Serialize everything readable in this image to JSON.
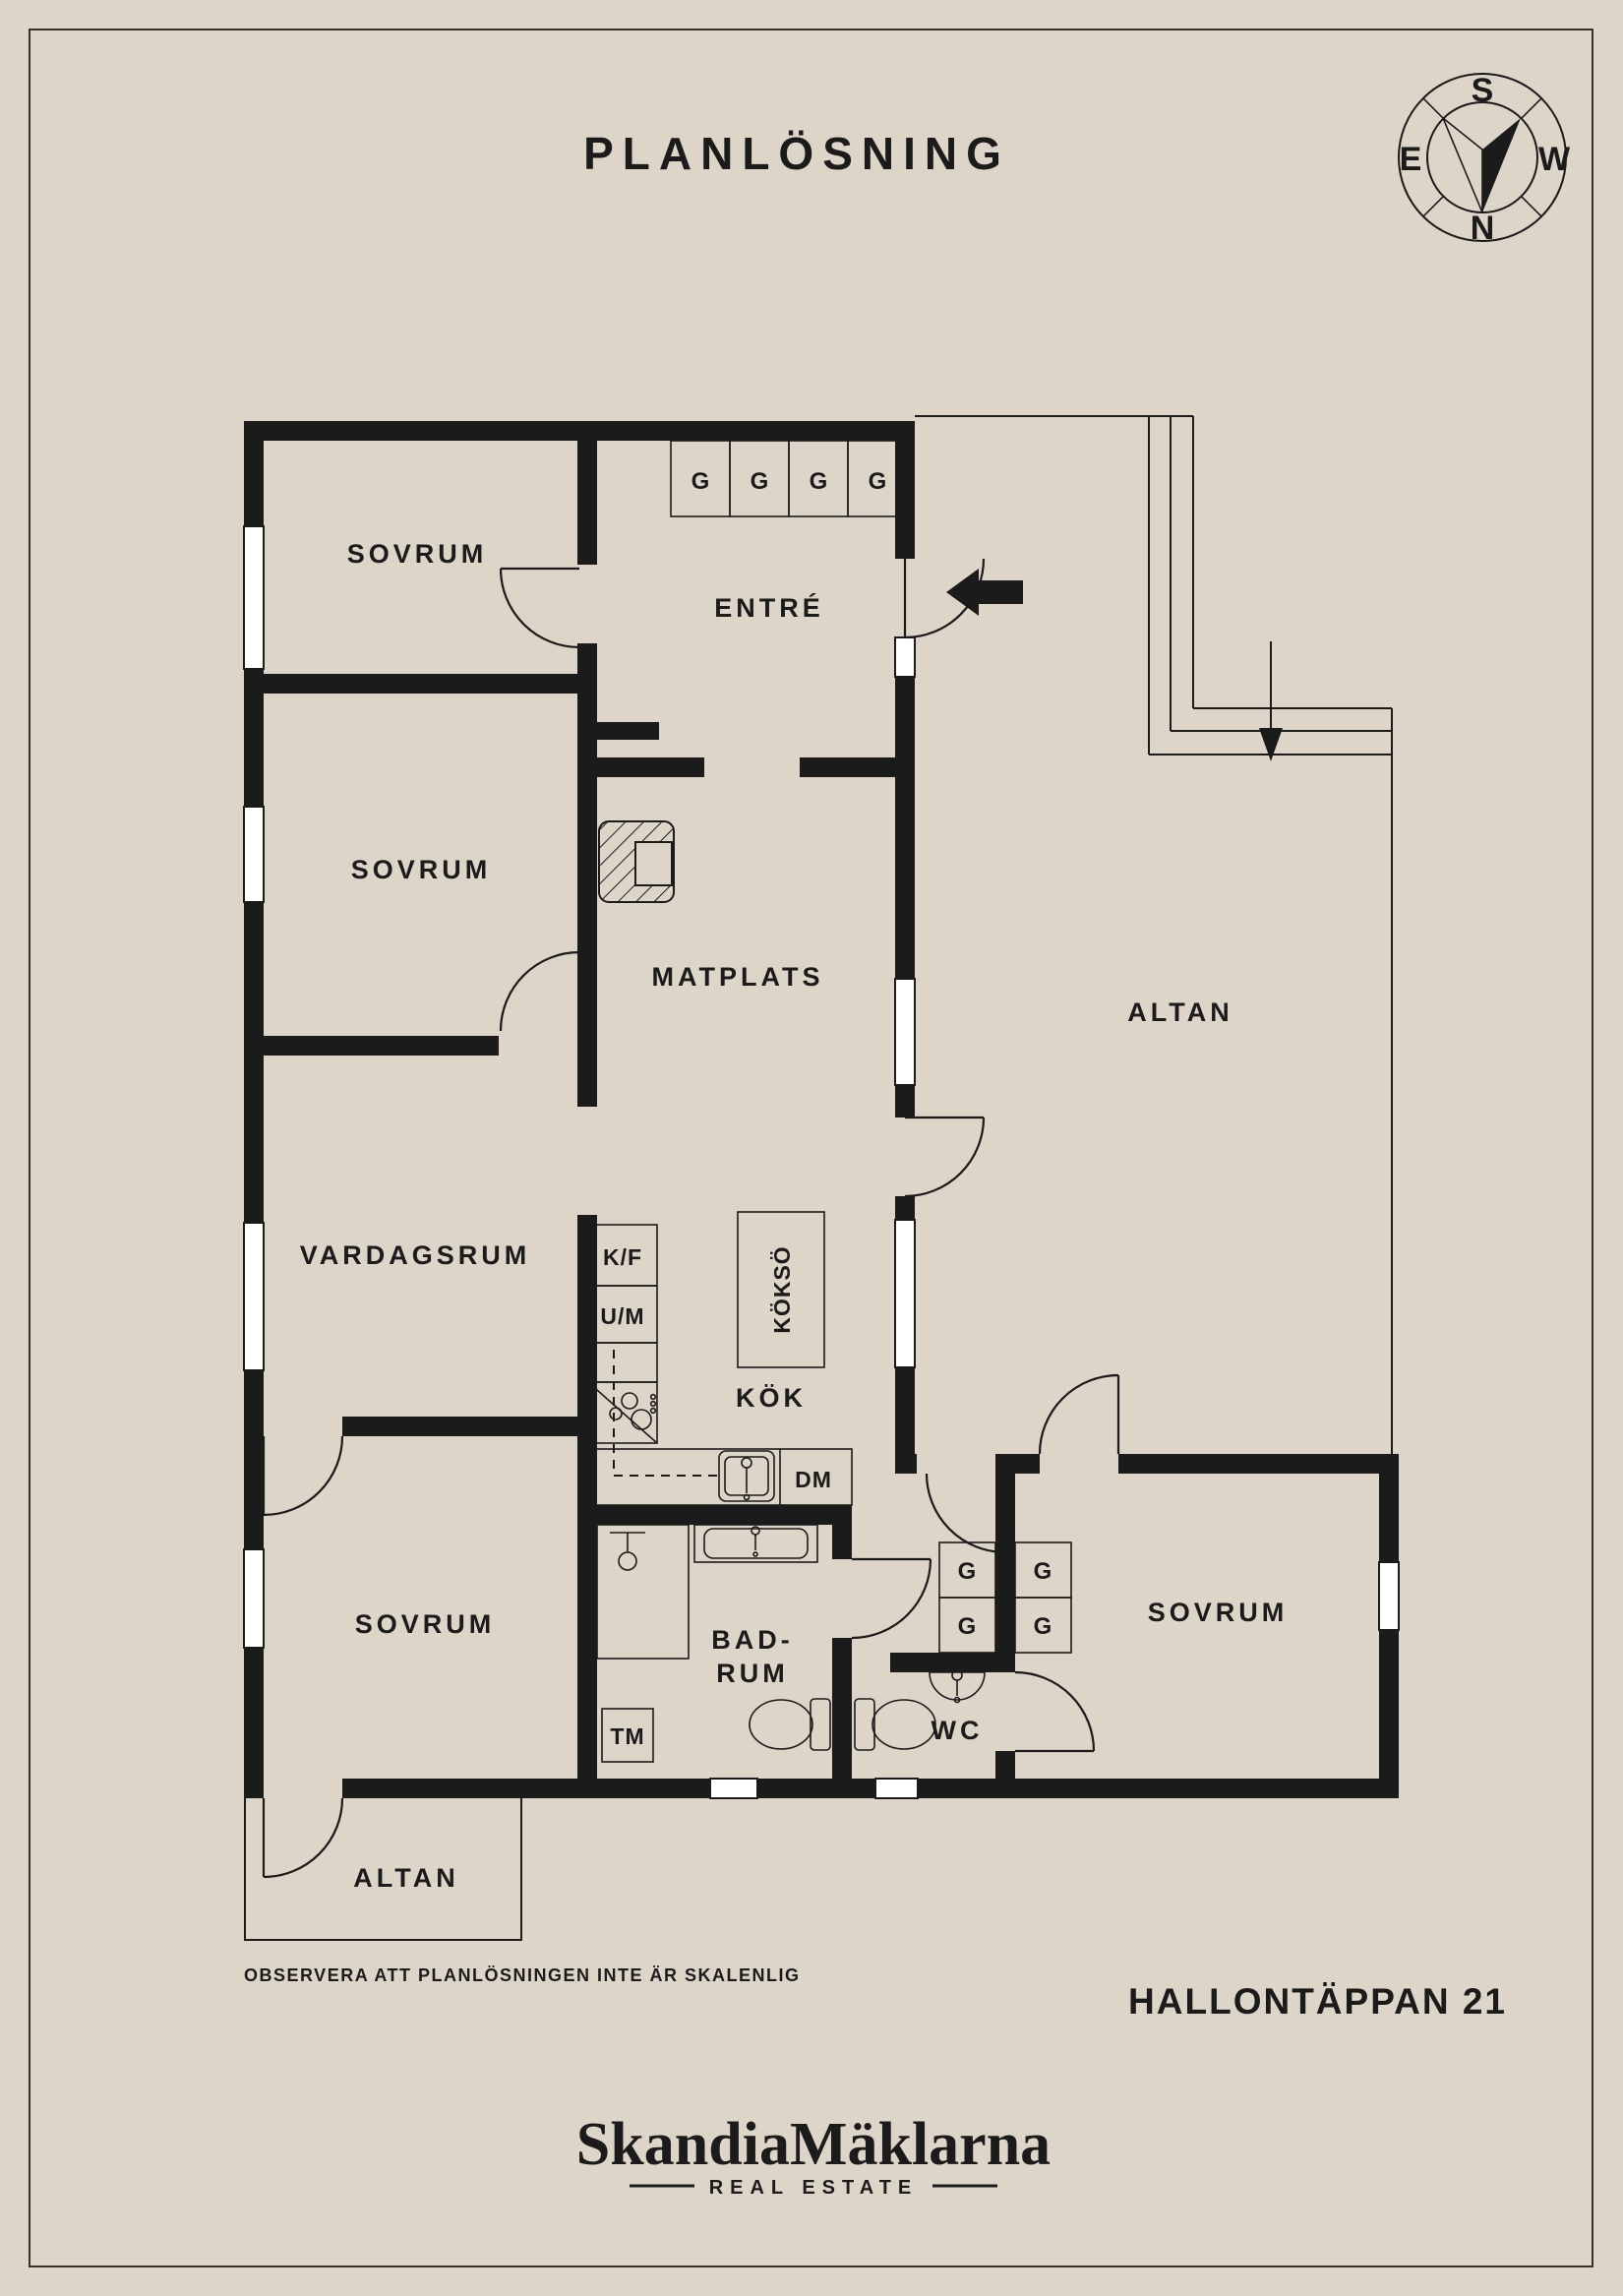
{
  "header": {
    "title": "PLANLÖSNING"
  },
  "compass": {
    "s": "S",
    "w": "W",
    "n": "N",
    "e": "E"
  },
  "rooms": {
    "sovrum_nw": {
      "label": "SOVRUM"
    },
    "entre": {
      "label": "ENTRÉ"
    },
    "sovrum_w": {
      "label": "SOVRUM"
    },
    "matplats": {
      "label": "MATPLATS"
    },
    "altan_e": {
      "label": "ALTAN"
    },
    "vardagsrum": {
      "label": "VARDAGSRUM"
    },
    "kok": {
      "label": "KÖK"
    },
    "koksso": {
      "label": "KÖKSÖ"
    },
    "sovrum_sw": {
      "label": "SOVRUM"
    },
    "sovrum_se": {
      "label": "SOVRUM"
    },
    "badrum": {
      "line1": "BAD-",
      "line2": "RUM"
    },
    "wc": {
      "label": "WC"
    },
    "altan_s": {
      "label": "ALTAN"
    }
  },
  "fixtures": {
    "kf": "K/F",
    "um": "U/M",
    "dm": "DM",
    "tm": "TM",
    "g": "G"
  },
  "footer": {
    "note": "OBSERVERA ATT PLANLÖSNINGEN INTE ÄR SKALENLIG",
    "address": "HALLONTÄPPAN 21",
    "brand": "SkandiaMäklarna",
    "tagline": "REAL ESTATE"
  },
  "colors": {
    "background": "#ded5c9",
    "ink": "#1b1b1b",
    "window": "#ffffff"
  }
}
